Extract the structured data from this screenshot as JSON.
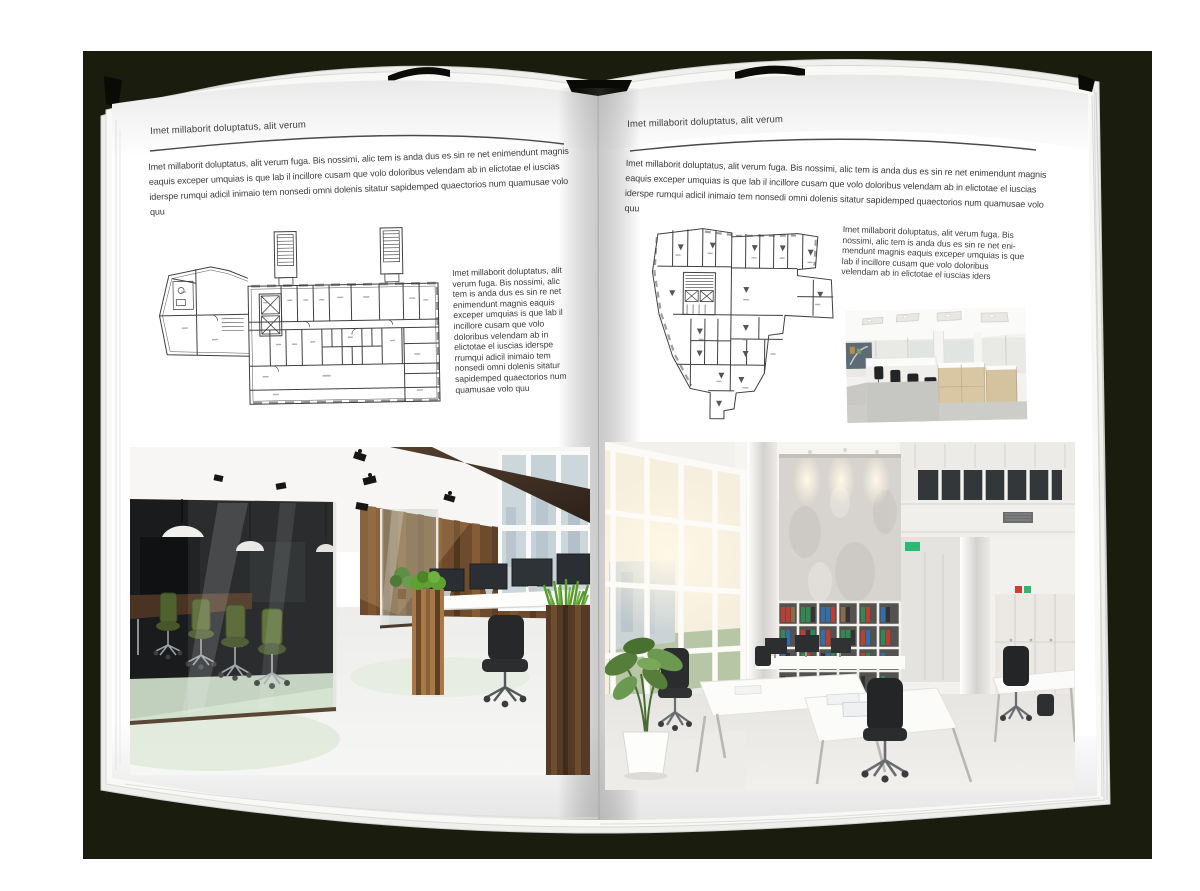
{
  "pages": [
    {
      "id": "left",
      "header": "Imet millaborit doluptatus, alit verum",
      "intro": "Imet millaborit doluptatus, alit verum fuga. Bis nossimi, alic tem is anda dus es sin re net enimendunt magnis eaquis exceper umquias is que lab il incillore cusam que volo doloribus velendam ab in elictotae el iuscias iderspe rumqui adicil inimaio tem nonsedi omni dolenis sitatur sapidemped quaectorios num quamusae volo quu",
      "side_text": "Imet millaborit doluptatus, alit verum fuga. Bis nossimi, alic tem is anda dus es sin re net enimendunt magnis eaquis exceper umquias is que lab il incillore cusam que volo doloribus velendam ab in elictotae el iuscias iderspe rrumqui adicil inimaio tem nonsedi omni dolenis sitatur sapidemped quaectorios num quamusae volo quu"
    },
    {
      "id": "right",
      "header": "Imet millaborit doluptatus, alit verum",
      "intro": "Imet millaborit doluptatus, alit verum fuga. Bis nossimi, alic tem is anda dus es sin re net enimendunt magnis eaquis exceper umquias is que lab il incillore cusam que volo doloribus velendam ab in elictotae el iuscias iderspe rumqui adicil inimaio tem nonsedi omni dolenis sitatur sapidemped quaectorios num quamusae volo quu",
      "side_text": "Imet millaborit doluptatus, alit verum fuga. Bis nossimi, alic tem is anda dus es sin re net eni-mendunt magnis eaquis exceper umquias is que lab il incillore cusam que volo doloribus velendam ab in elictotae el iuscias iders"
    }
  ],
  "colors": {
    "backdrop": "#1a1c0e",
    "page": "#ffffff",
    "rule": "#4a4a4a",
    "body_text": "#3c3c3c",
    "plan_line": "#3f3f3f",
    "photo_green_accent": "#5a9e32",
    "photo_wood": "#6e4b2d"
  }
}
